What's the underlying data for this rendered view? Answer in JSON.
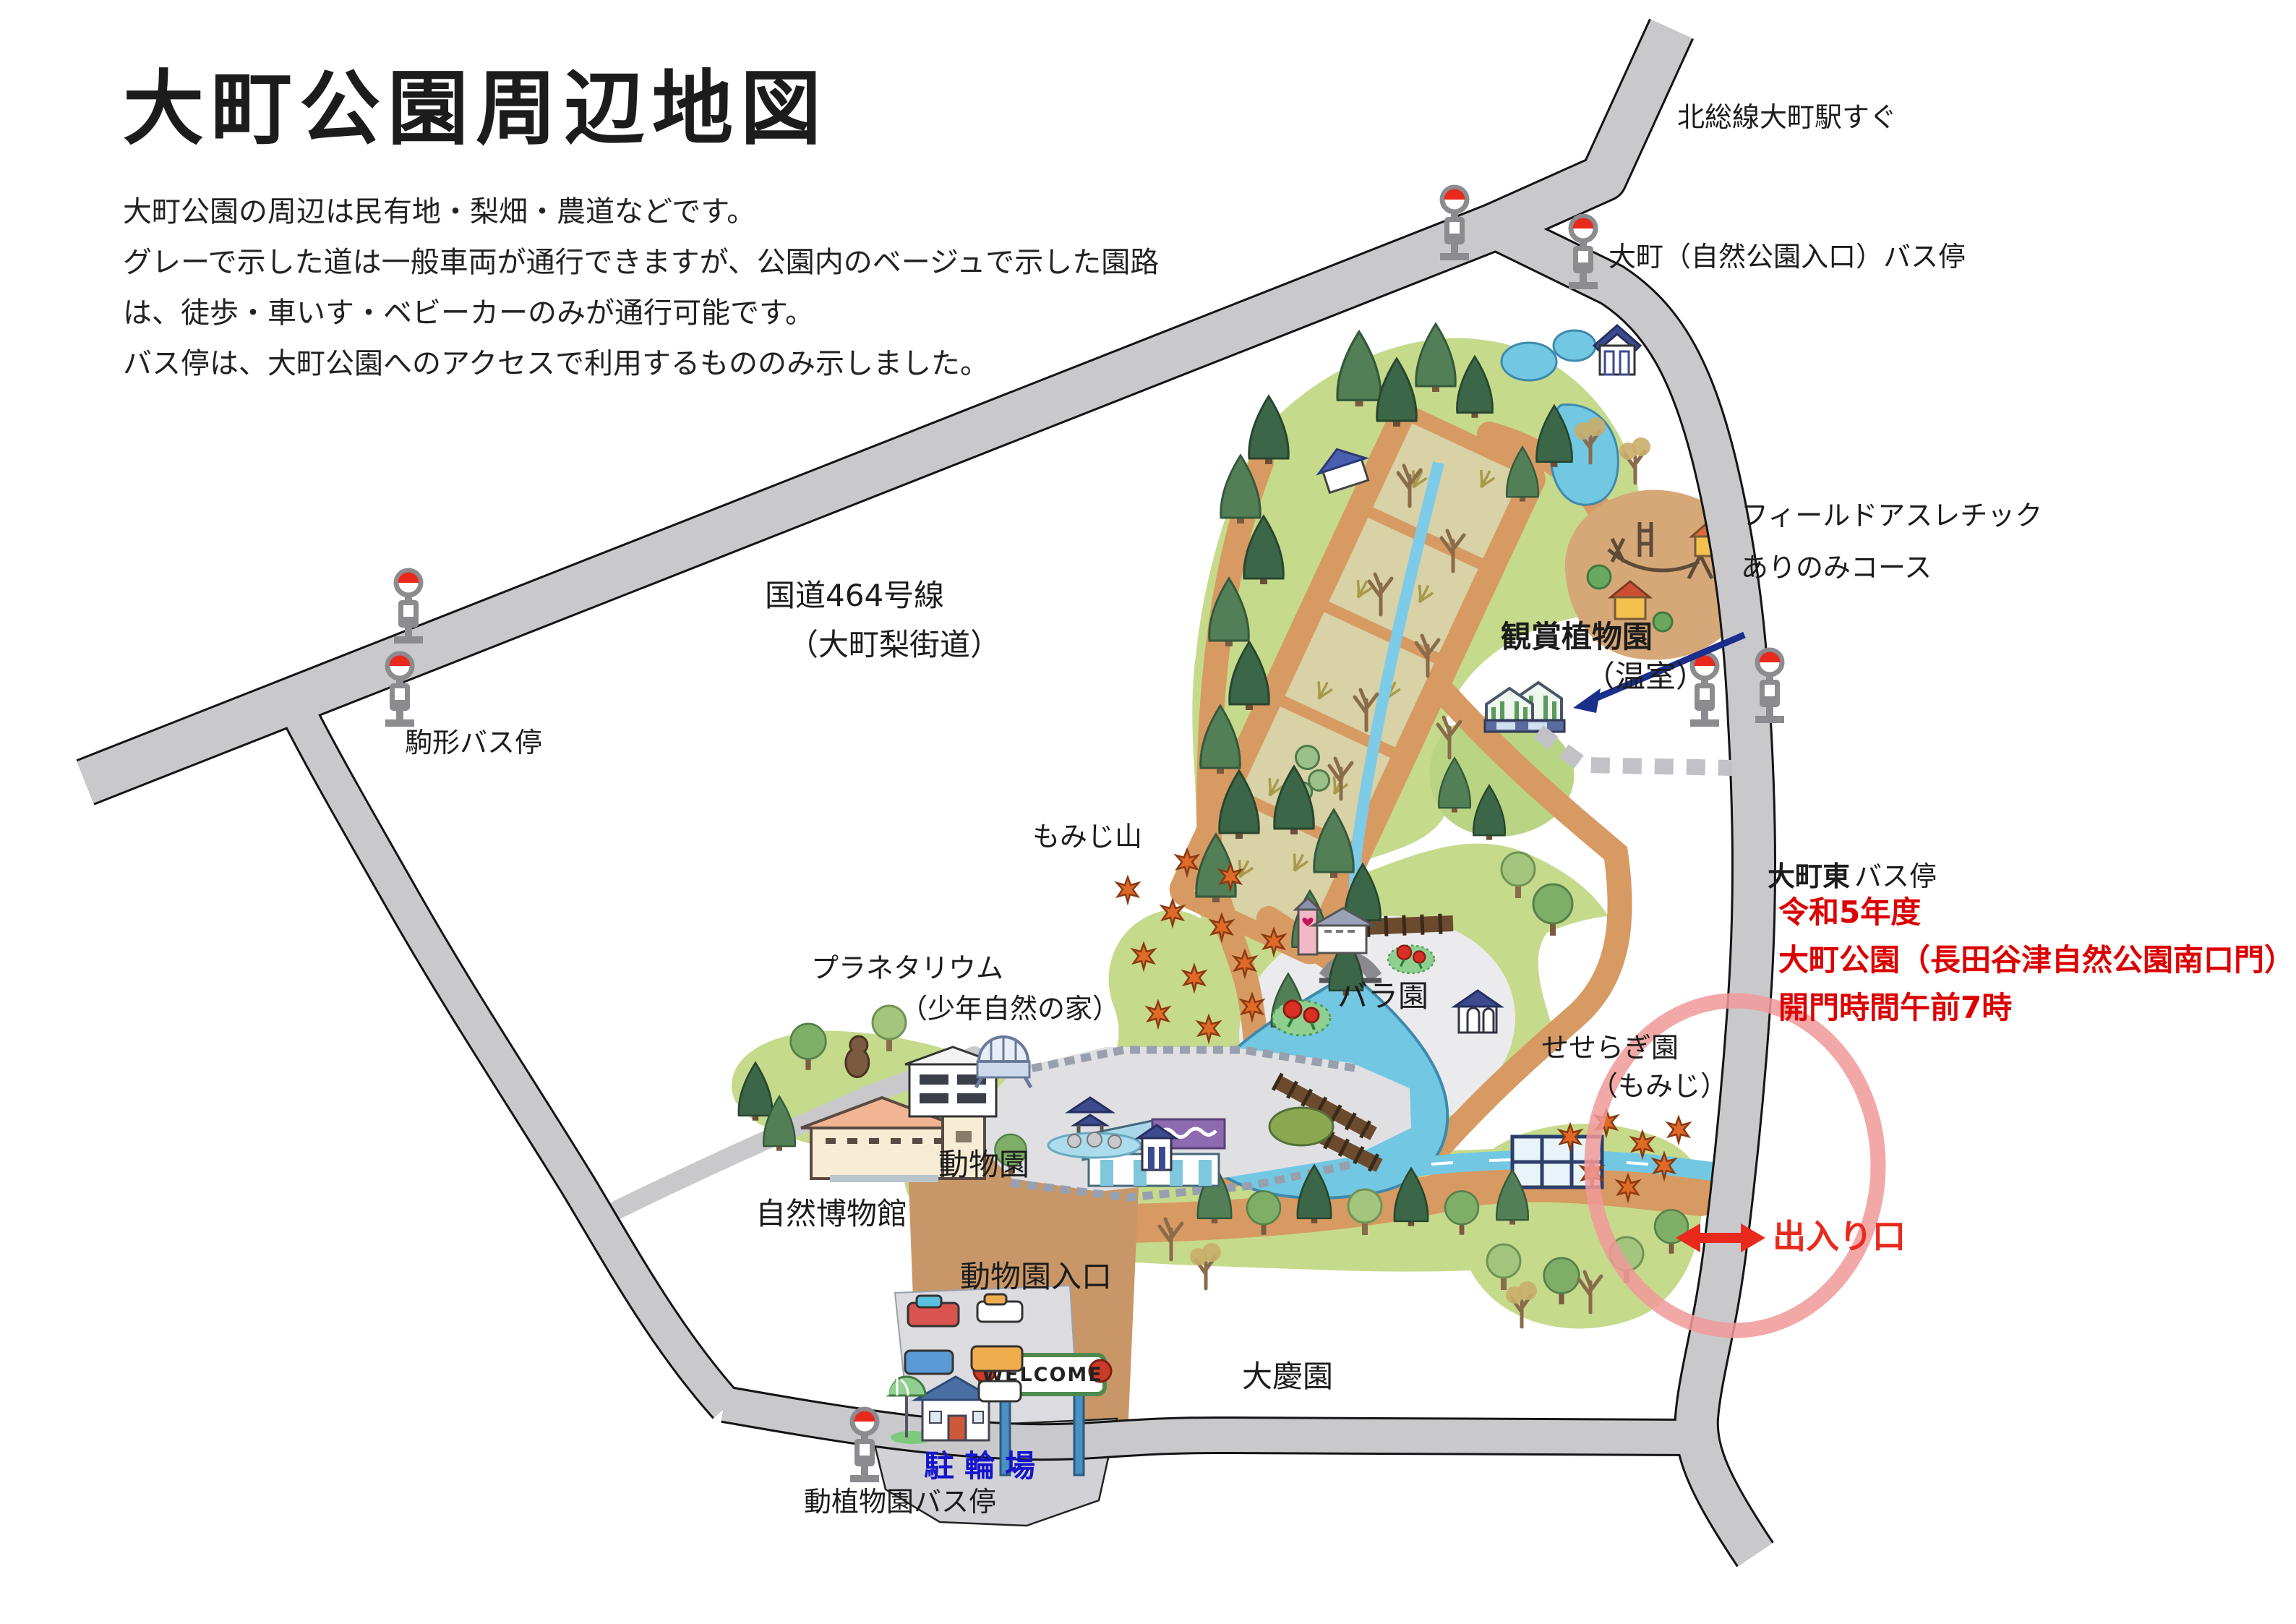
{
  "title": "大町公園周辺地図",
  "description": {
    "line1": "大町公園の周辺は民有地・梨畑・農道などです。",
    "line2": "グレーで示した道は一般車両が通行できますが、公園内のベージュで示した園路",
    "line3": "は、徒歩・車いす・ベビーカーのみが通行可能です。",
    "line4": "バス停は、大町公園へのアクセスで利用するもののみ示しました。"
  },
  "labels": {
    "station_note": "北総線大町駅すぐ",
    "bus_stop_omachi": "大町（自然公園入口）バス停",
    "route464_line1": "国道464号線",
    "route464_line2": "（大町梨街道）",
    "bus_stop_komagata": "駒形バス停",
    "athletic_line1": "フィールドアスレチック",
    "athletic_line2": "ありのみコース",
    "greenhouse_line1": "観賞植物園",
    "greenhouse_line2": "（温室）",
    "bus_stop_omachi_higashi": "大町東",
    "bus_stop_omachi_higashi_suffix": "バス停",
    "momiji_hill": "もみじ山",
    "planetarium_line1": "プラネタリウム",
    "planetarium_line2": "（少年自然の家）",
    "rose_garden": "バラ園",
    "seseragi_line1": "せせらぎ園",
    "seseragi_line2": "（もみじ）",
    "zoo": "動物園",
    "museum": "自然博物館",
    "zoo_entrance": "動物園入口",
    "daikeien": "大慶園",
    "bicycle_parking": "駐輪場",
    "bus_stop_zoo_botanical": "動植物園バス停"
  },
  "notice": {
    "line1": "令和5年度",
    "line2": "大町公園（長田谷津自然公園南口門）",
    "line3": "開門時間午前7時"
  },
  "gate": {
    "label": "出入り口"
  },
  "welcome_sign": "WELCOME",
  "colors": {
    "road_gray": "#c9c9cc",
    "park_green": "#c6da8c",
    "path_brown": "#d79a62",
    "field_beige": "#d8d2a6",
    "water_blue": "#72c8e2",
    "notice_red": "#dd0000",
    "gate_red": "#e8291c",
    "bicycle_blue": "#1515cc",
    "highlight_pink": "#f19999",
    "arrow_navy": "#1a2e8c"
  }
}
